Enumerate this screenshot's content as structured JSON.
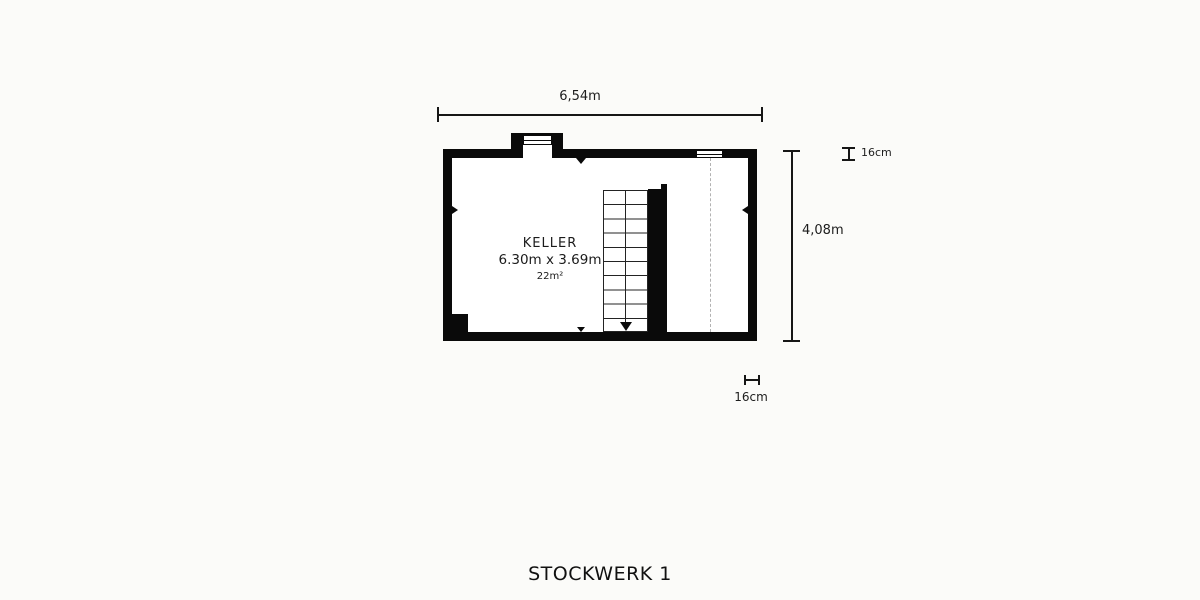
{
  "title": "STOCKWERK 1",
  "floor_plan": {
    "room": {
      "name": "KELLER",
      "size_label": "6.30m x 3.69m",
      "area_label": "22m²"
    },
    "dimensions": {
      "overall_width": "6,54m",
      "overall_height": "4,08m",
      "wall_thickness_top": "16cm",
      "wall_thickness_bottom": "16cm"
    },
    "colors": {
      "wall": "#0a0a0a",
      "dimension_line": "#161616",
      "dashed_line": "#b2b2b2",
      "text": "#1d1d1d",
      "background": "#fbfbf9",
      "floor": "#ffffff"
    }
  }
}
